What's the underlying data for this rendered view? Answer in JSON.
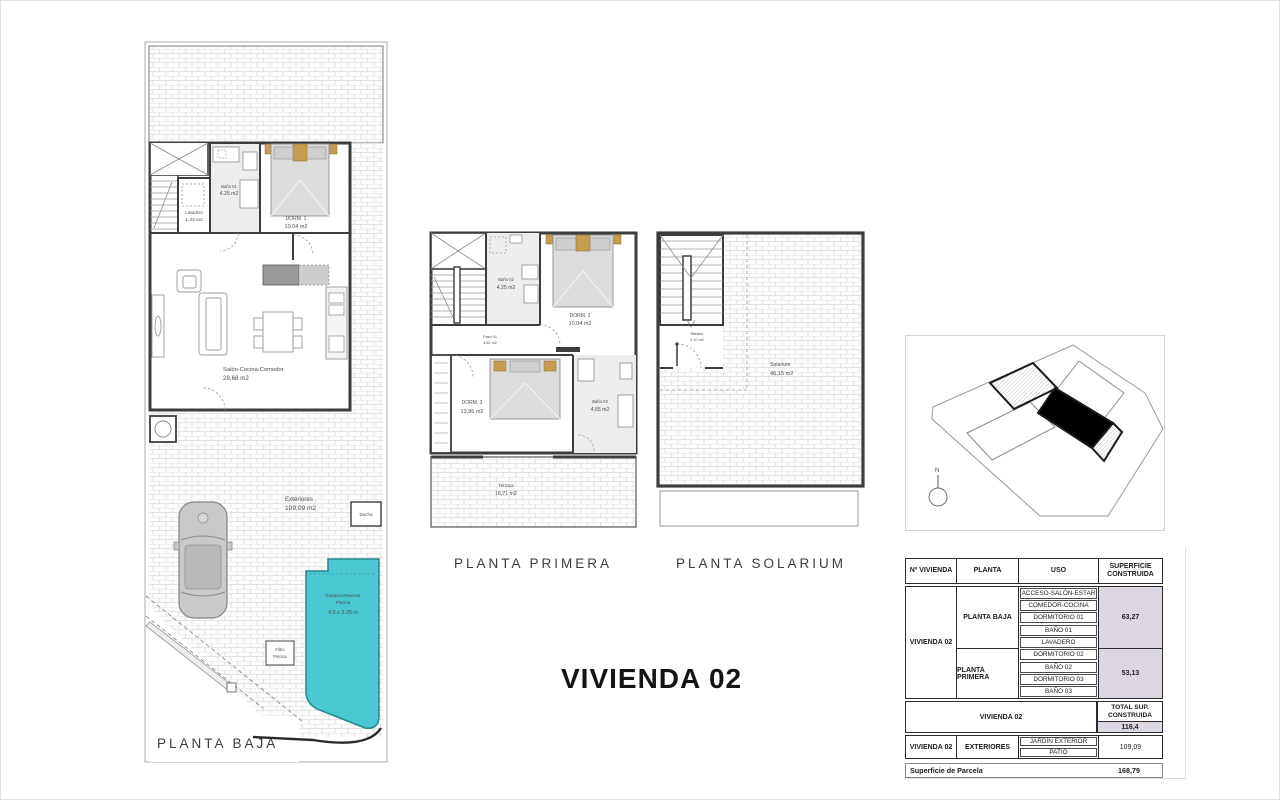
{
  "title": "VIVIENDA 02",
  "plans": {
    "baja": {
      "caption": "PLANTA BAJA",
      "rooms": {
        "bano01": {
          "name": "Baño 01",
          "area": "4.25 m2"
        },
        "lavadero": {
          "name": "Lavadero",
          "area": "1,33 m2"
        },
        "dorm1": {
          "name": "DORM. 1",
          "area": "10.04 m2"
        },
        "salon": {
          "name": "Salón-Cocina-Comedor",
          "area": "28,68 m2"
        },
        "exteriores": {
          "name": "Exteriores",
          "area": "109,09 m2"
        },
        "ducha": {
          "name": "Ducha"
        },
        "piscina": {
          "line1": "Espacio Reserva",
          "line2": "Piscina",
          "line3": "4.5 x 2.25 m"
        },
        "filtro": {
          "line1": "Filtro",
          "line2": "Piscina"
        }
      }
    },
    "primera": {
      "caption": "PLANTA PRIMERA",
      "rooms": {
        "bano02": {
          "name": "Baño 02",
          "area": "4.25 m2"
        },
        "dorm2": {
          "name": "DORM. 2",
          "area": "10,04 m2"
        },
        "paso": {
          "name": "Paso 01",
          "area": "3.60 m2"
        },
        "dorm3": {
          "name": "DORM. 3",
          "area": "13,95 m2"
        },
        "bano03": {
          "name": "Baño 03",
          "area": "4,65 m2"
        },
        "terraza": {
          "name": "Terraza",
          "area": "16,71 m2"
        }
      }
    },
    "solarium": {
      "caption": "PLANTA SOLARIUM",
      "rooms": {
        "rellano": {
          "name": "Rellano",
          "area": "2,10 m2"
        },
        "solarium": {
          "name": "Solarium",
          "area": "46,15 m2"
        }
      }
    }
  },
  "site_plan": {
    "north_label": "N"
  },
  "table": {
    "headers": {
      "col1": "Nº VIVIENDA",
      "col2": "PLANTA",
      "col3": "USO",
      "col4": "SUPERFICIE CONSTRUIDA"
    },
    "vivienda": "VIVIENDA 02",
    "planta_baja": {
      "label": "PLANTA BAJA",
      "usos": [
        "ACCESO-SALÓN-ESTAR",
        "COMEDOR-COCINA",
        "DORMITORIO 01",
        "BAÑO 01",
        "LAVADERO"
      ],
      "superficie": "63,27"
    },
    "planta_primera": {
      "label": "PLANTA PRIMERA",
      "usos": [
        "DORMITORIO 02",
        "BAÑO 02",
        "DORMITORIO 03",
        "BAÑO 03"
      ],
      "superficie": "53,13"
    },
    "total": {
      "label": "VIVIENDA 02",
      "header": "TOTAL SUP. CONSTRUIDA",
      "value": "116,4"
    },
    "exteriores": {
      "vivienda": "VIVIENDA 02",
      "label": "EXTERIORES",
      "usos": [
        "JARDÍN EXTERIOR",
        "PATIO"
      ],
      "superficie": "109,09"
    },
    "parcela": {
      "label": "Superficie de Parcela",
      "value": "168,79"
    }
  },
  "colors": {
    "pool": "#4cc8d2",
    "wall": "#3d3d3d",
    "lavender": "#ddd6e3",
    "bed_tan": "#c59d52"
  }
}
